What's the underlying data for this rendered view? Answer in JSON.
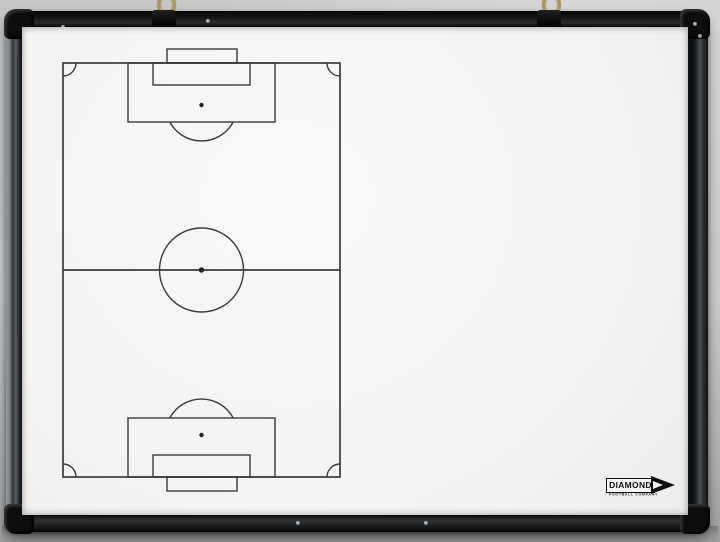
{
  "logo": {
    "brand": "DIAMOND",
    "tagline": "FOOTBALL COMPANY"
  },
  "colors": {
    "wall": "#cbcbcb",
    "wall_shadow": "#9d9d9d",
    "frame_black": "#141414",
    "frame_highlight": "#989da1",
    "surface_white": "#f4f3f1",
    "pitch_line": "#3a3a3e",
    "hook_brass": "#b2954e",
    "logo_ink": "#101010"
  },
  "hardware": {
    "hook_count": 2,
    "hooks": [
      "hanging-hook-left",
      "hanging-hook-right"
    ]
  },
  "pitch": {
    "orientation": "vertical",
    "markings": [
      "pitch-outline",
      "halfway-line",
      "centre-circle",
      "centre-spot",
      "goal-top",
      "goal-area-top",
      "penalty-area-top",
      "penalty-spot-top",
      "penalty-arc-top",
      "goal-bottom",
      "goal-area-bottom",
      "penalty-area-bottom",
      "penalty-spot-bottom",
      "penalty-arc-bottom",
      "corner-arc-top-left",
      "corner-arc-top-right",
      "corner-arc-bottom-left",
      "corner-arc-bottom-right"
    ]
  }
}
